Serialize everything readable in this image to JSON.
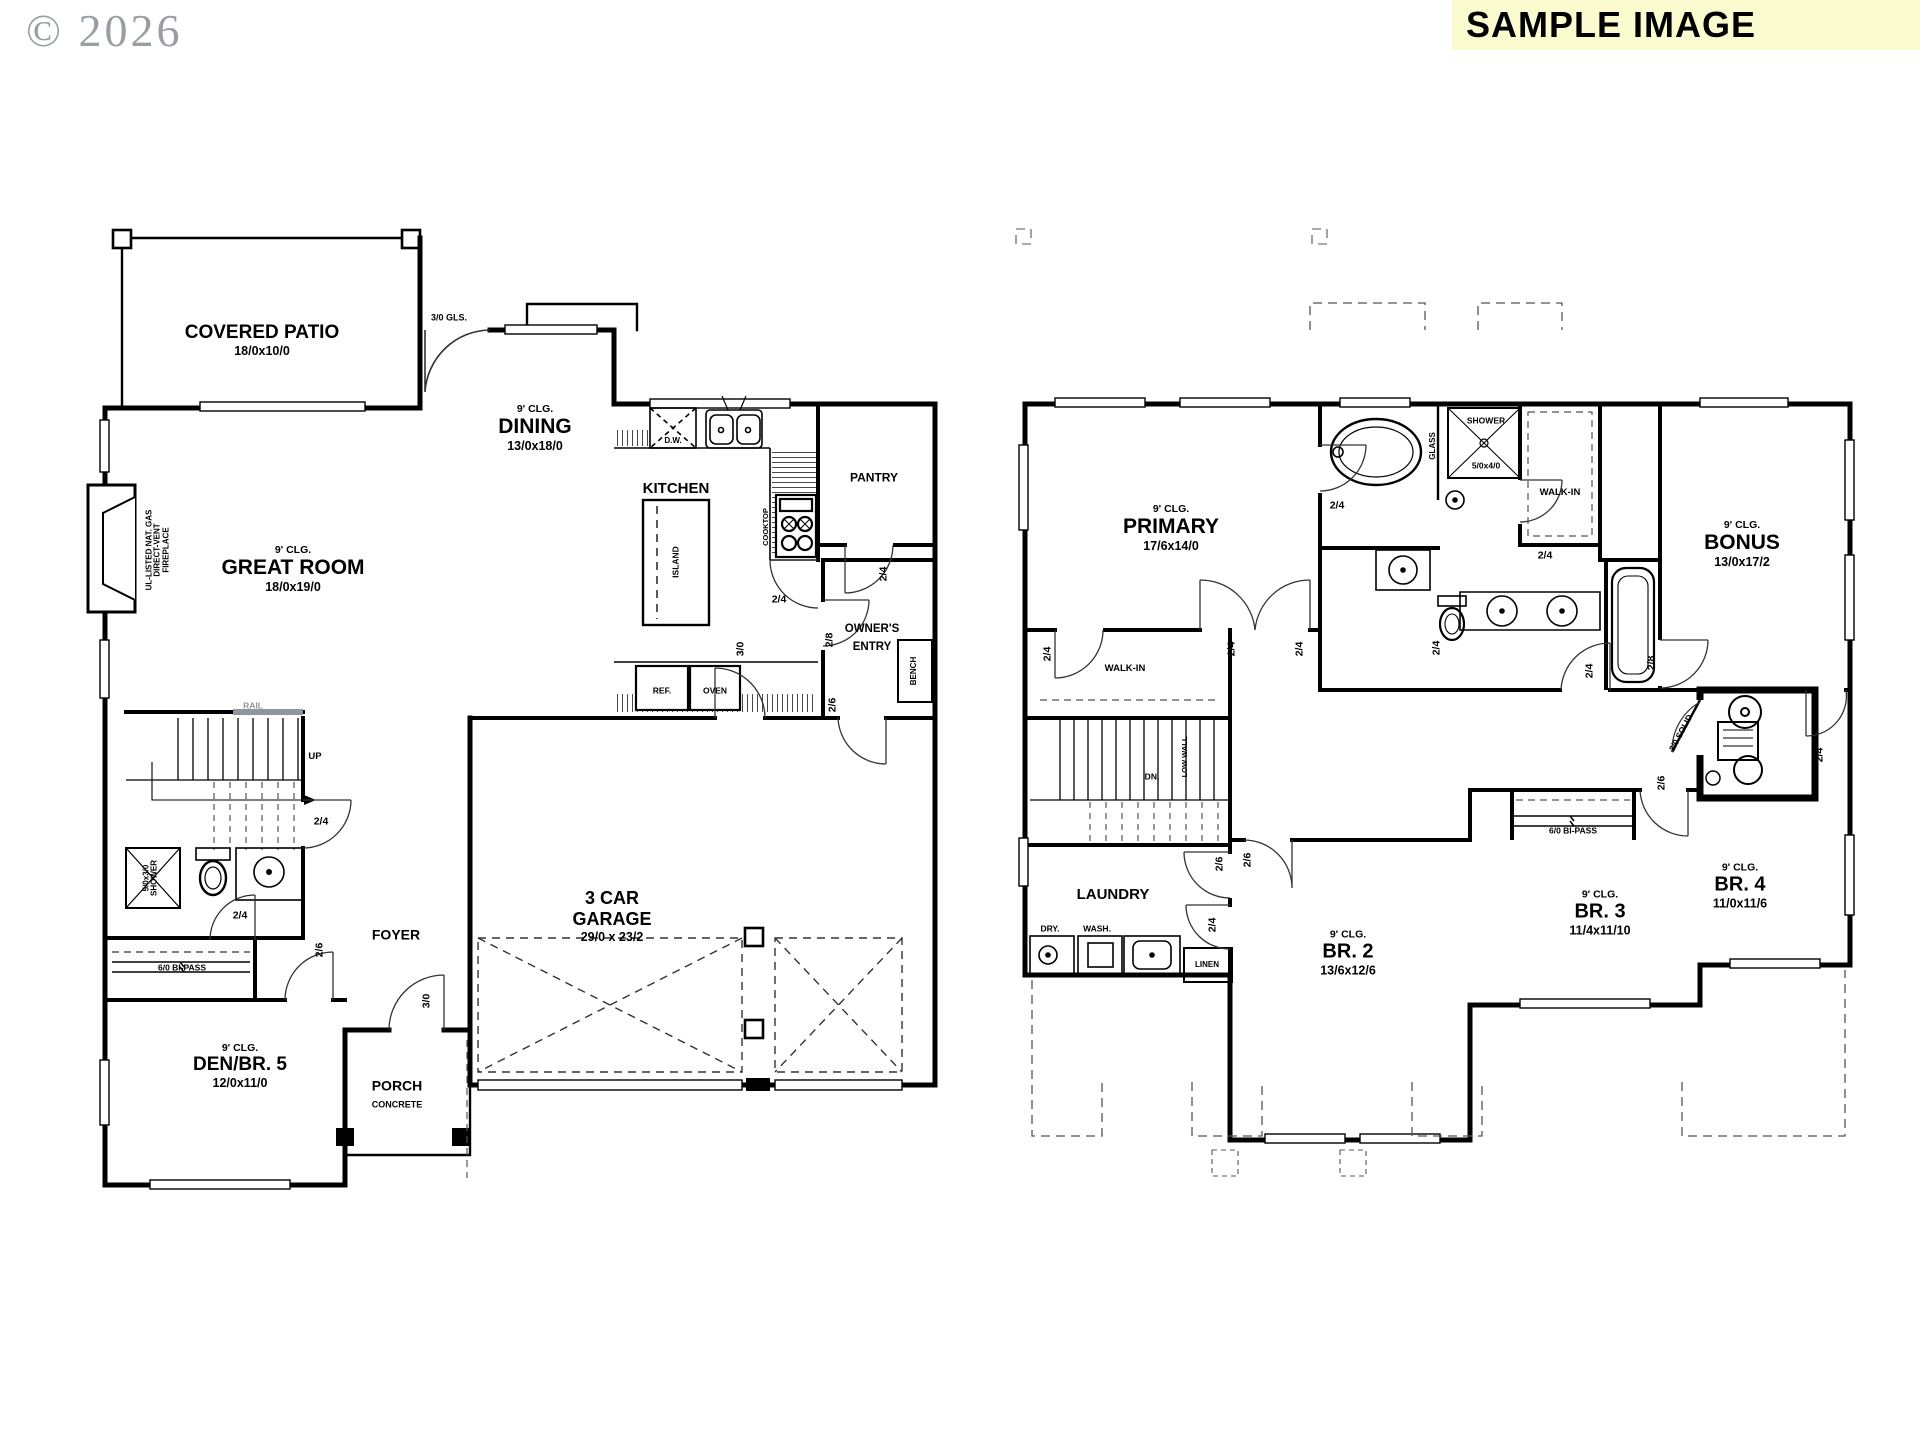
{
  "watermark": "© 2026",
  "banner": {
    "text": "SAMPLE IMAGE",
    "bg_color": "#FBFBD0"
  },
  "floor1": {
    "patio": {
      "title": "COVERED PATIO",
      "dims": "18/0x10/0",
      "door": "3/0 GLS."
    },
    "dining": {
      "clg": "9' CLG.",
      "title": "DINING",
      "dims": "13/0x18/0"
    },
    "great_room": {
      "clg": "9' CLG.",
      "title": "GREAT ROOM",
      "dims": "18/0x19/0"
    },
    "fireplace_note": "UL-LISTED NAT. GAS\nDIRECT-VENT\nFIREPLACE",
    "kitchen": {
      "title": "KITCHEN",
      "island": "ISLAND",
      "dw": "D.W.",
      "cooktop": "COOKTOP",
      "ref": "REF.",
      "oven": "OVEN",
      "hall_door": "2/4"
    },
    "pantry": {
      "title": "PANTRY",
      "door": "2/4"
    },
    "owners_entry": {
      "line1": "OWNER'S",
      "line2": "ENTRY",
      "bench": "BENCH",
      "door1": "2/8",
      "door2": "2/6",
      "garage_door": "3/0"
    },
    "stairs": {
      "rail": "RAIL",
      "up": "UP",
      "door": "2/4"
    },
    "powder": {
      "shower": "5/0x3/0\nSHOWER"
    },
    "foyer": {
      "title": "FOYER",
      "closet_door": "2/4",
      "den_door": "2/6",
      "front_door": "3/0",
      "bipass": "6/0 BI-PASS"
    },
    "den": {
      "clg": "9' CLG.",
      "title": "DEN/BR. 5",
      "dims": "12/0x11/0"
    },
    "porch": {
      "title": "PORCH",
      "sub": "CONCRETE"
    },
    "garage": {
      "line1": "3 CAR",
      "line2": "GARAGE",
      "dims": "29/0 x 23/2"
    }
  },
  "floor2": {
    "primary": {
      "clg": "9' CLG.",
      "title": "PRIMARY",
      "dims": "17/6x14/0",
      "door_l": "2/4",
      "door_r": "2/4",
      "bath_door": "2/4"
    },
    "bath": {
      "glass": "GLASS",
      "shower": "SHOWER",
      "shower_dims": "5/0x4/0",
      "wc_door": "2/4",
      "hall_door": "2/4"
    },
    "walkin_primary": {
      "title": "WALK-IN",
      "door": "2/4"
    },
    "walkin2": {
      "title": "WALK-IN",
      "door": "2/4"
    },
    "bonus": {
      "clg": "9' CLG.",
      "title": "BONUS",
      "dims": "13/0x17/2",
      "door": "2/8"
    },
    "stairs": {
      "dn": "DN.",
      "low_wall": "LOW WALL"
    },
    "laundry": {
      "title": "LAUNDRY",
      "dry": "DRY.",
      "wash": "WASH.",
      "linen": "LINEN",
      "door": "2/4",
      "hall_door": "2/6"
    },
    "br2": {
      "clg": "9' CLG.",
      "title": "BR. 2",
      "dims": "13/6x12/6",
      "door": "2/6"
    },
    "br3": {
      "clg": "9' CLG.",
      "title": "BR. 3",
      "dims": "11/4x11/10",
      "door": "2/6",
      "bipass": "6/0 BI-PASS"
    },
    "br4": {
      "clg": "9' CLG.",
      "title": "BR. 4",
      "dims": "11/0x11/6",
      "door": "2/4"
    },
    "mech": {
      "door": "3/0 SOLID"
    }
  }
}
